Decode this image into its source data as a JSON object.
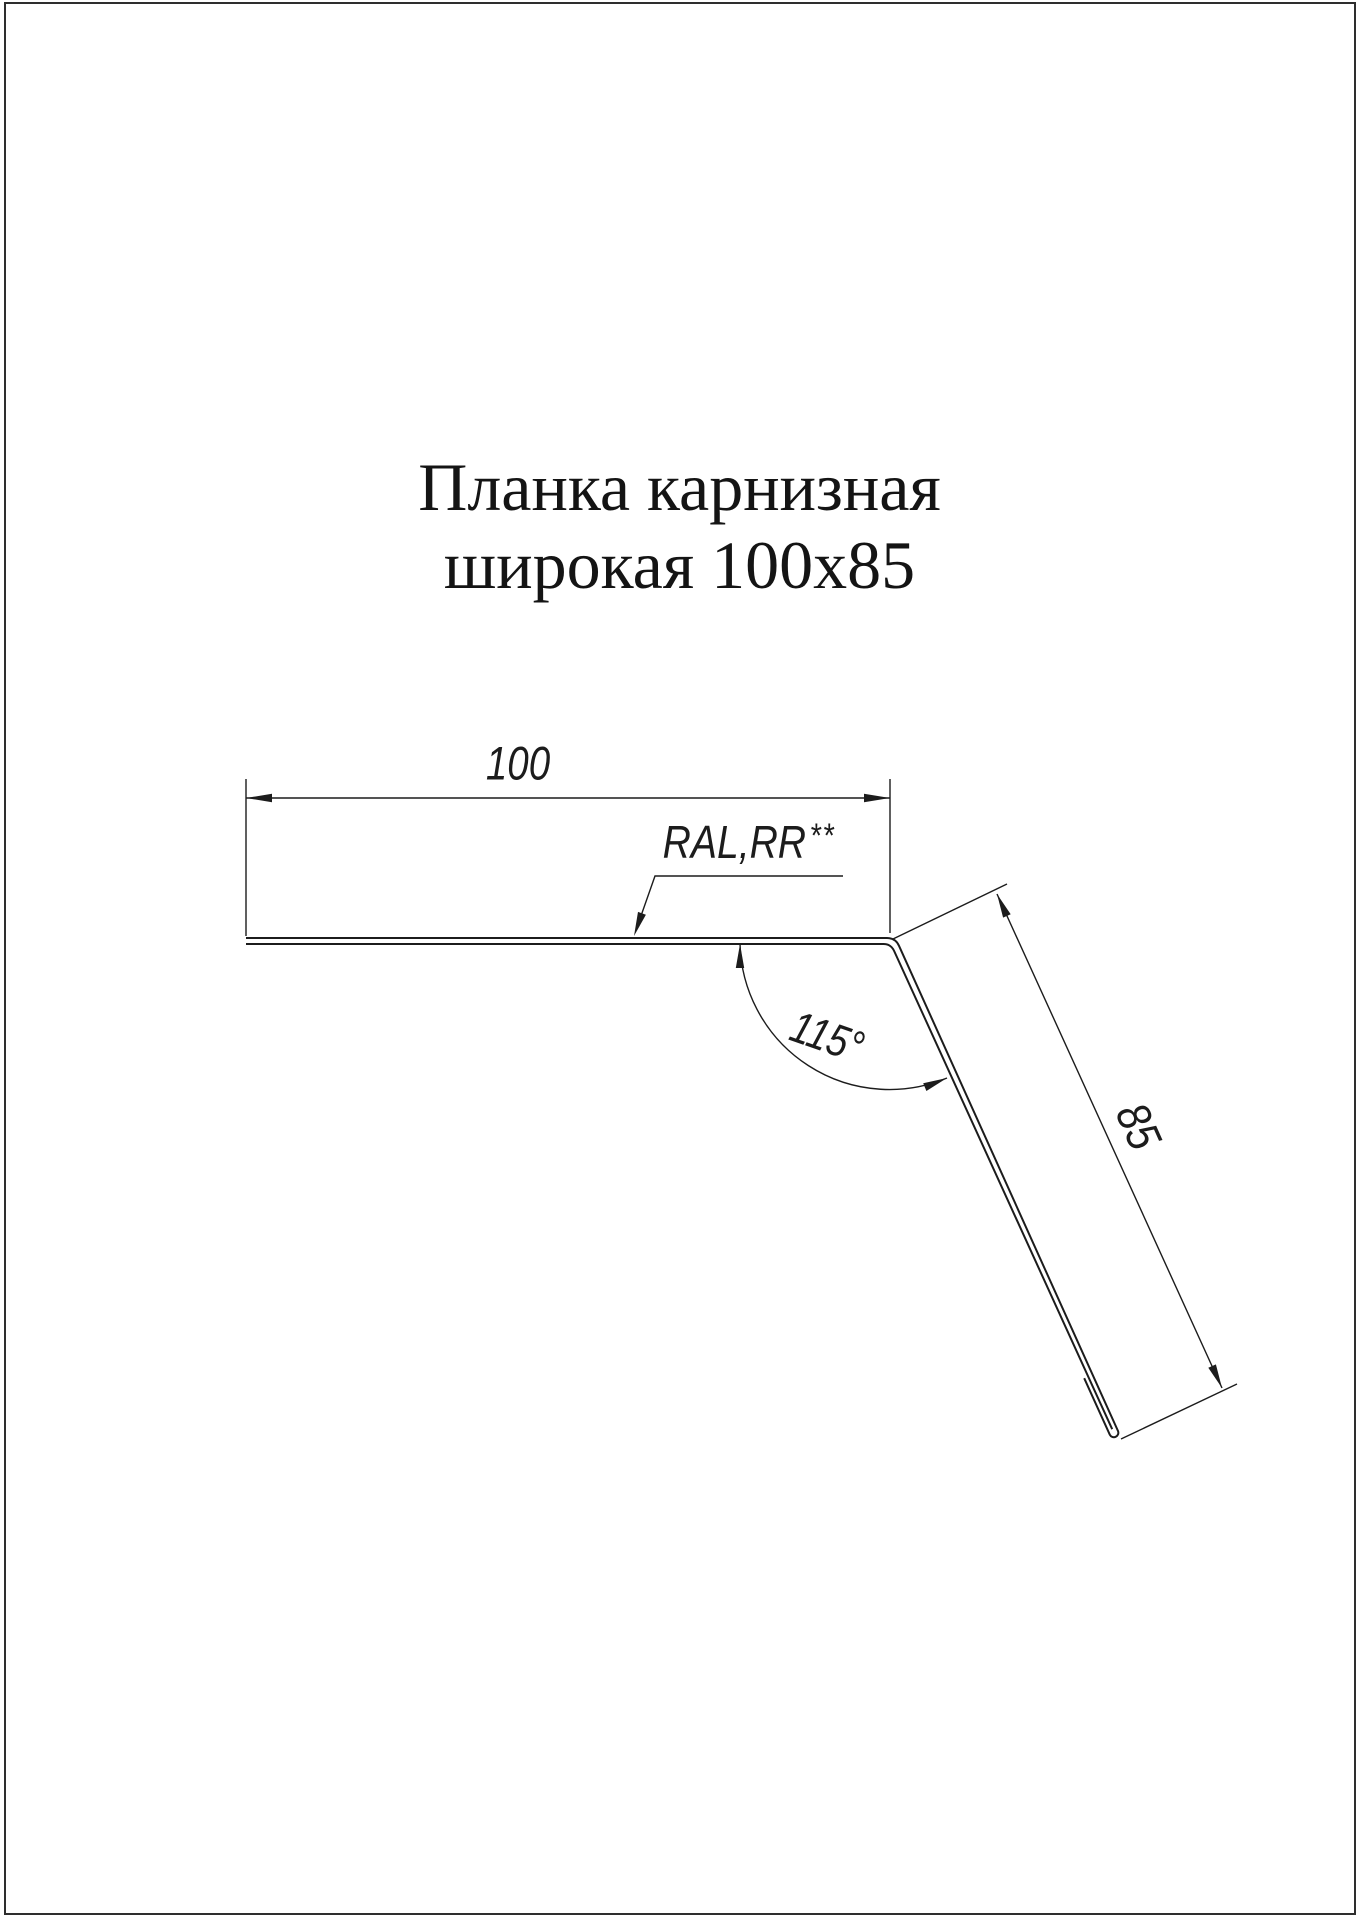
{
  "page": {
    "background_color": "#ffffff",
    "frame_color": "#2e2e2e",
    "line_color": "#1c1c1c"
  },
  "title": {
    "line1": "Планка карнизная",
    "line2": "широкая 100x85"
  },
  "drawing": {
    "width_dimension": "100",
    "flange_dimension": "85",
    "angle_dimension": "115°",
    "material_note": "RAL,RR",
    "material_note_suffix": "**"
  }
}
